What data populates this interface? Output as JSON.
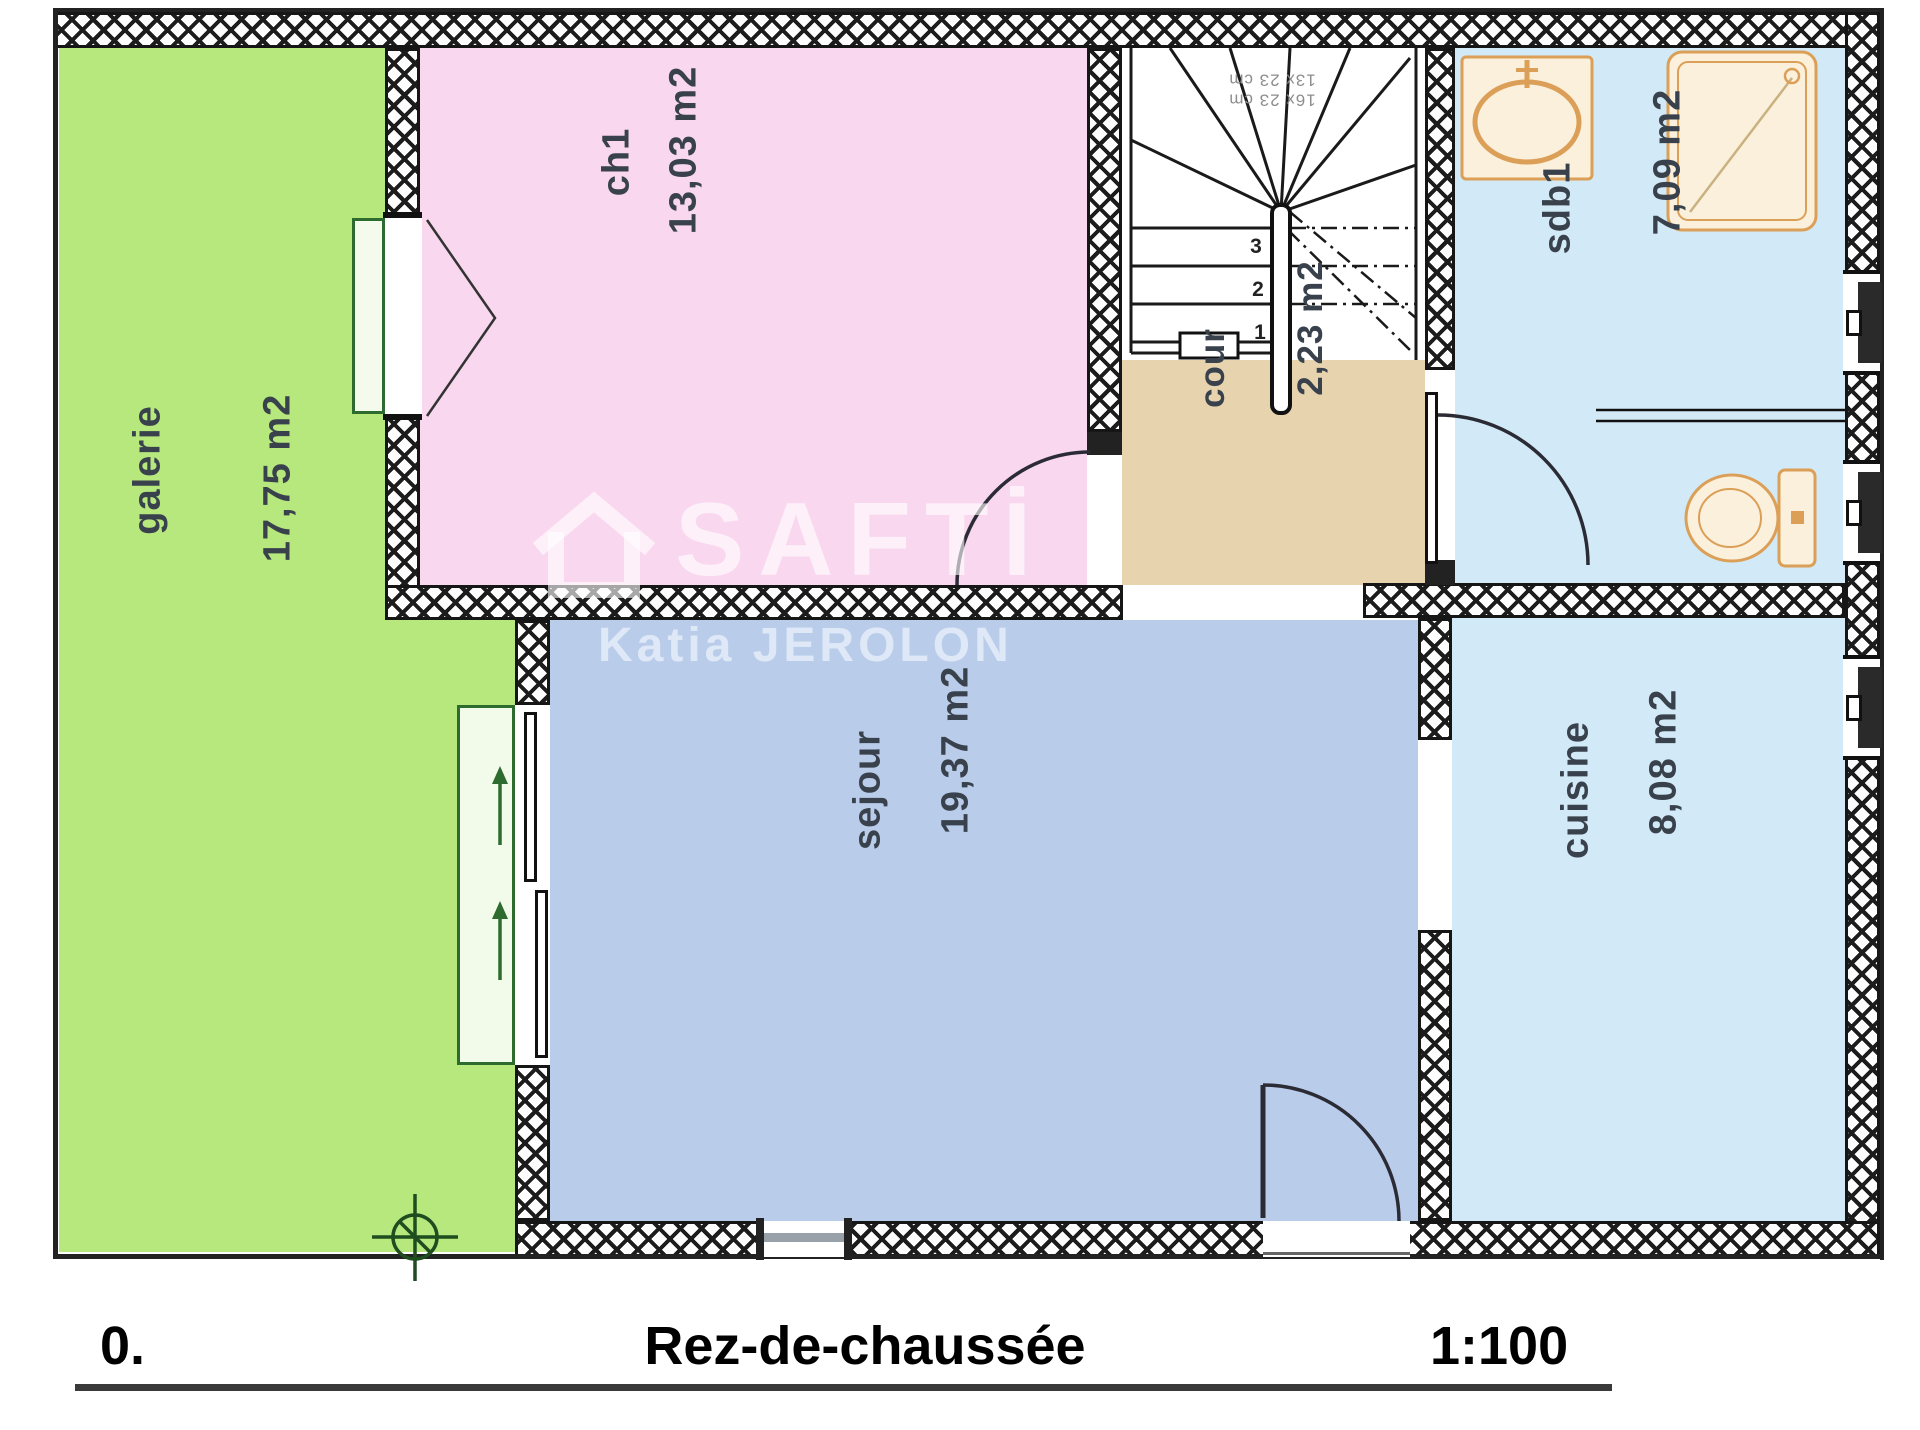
{
  "rooms": {
    "galerie": {
      "label": "galerie",
      "area": "17,75 m2"
    },
    "ch1": {
      "label": "ch1",
      "area": "13,03 m2"
    },
    "sejour": {
      "label": "sejour",
      "area": "19,37 m2"
    },
    "cuisine": {
      "label": "cuisine",
      "area": "8,08 m2"
    },
    "sdb1": {
      "label": "sdb1",
      "area": "7,09 m2"
    },
    "cour": {
      "label": "cour",
      "area": "2,23 m2"
    }
  },
  "stairs": {
    "steps": [
      "1",
      "2",
      "3"
    ],
    "annotation": [
      "16x 23 cm",
      "13x 23 cm"
    ]
  },
  "footer": {
    "level": "0.",
    "title": "Rez-de-chaussée",
    "scale": "1:100"
  },
  "watermark": {
    "brand": "SAFTİ",
    "agent": "Katia JEROLON"
  },
  "colors": {
    "galerie": "#b6e87d",
    "ch1": "#f9d7ee",
    "sejour": "#b9cdeb",
    "cuisine": "#d2eaf7",
    "sdb1": "#d2eaf7",
    "cour": "#e7d4af",
    "fixture_fill": "#faf0dc",
    "fixture_stroke": "#dc9f57",
    "wall_line": "#161616",
    "label_text": "#39424c",
    "accent_green": "#2e6b2e"
  }
}
